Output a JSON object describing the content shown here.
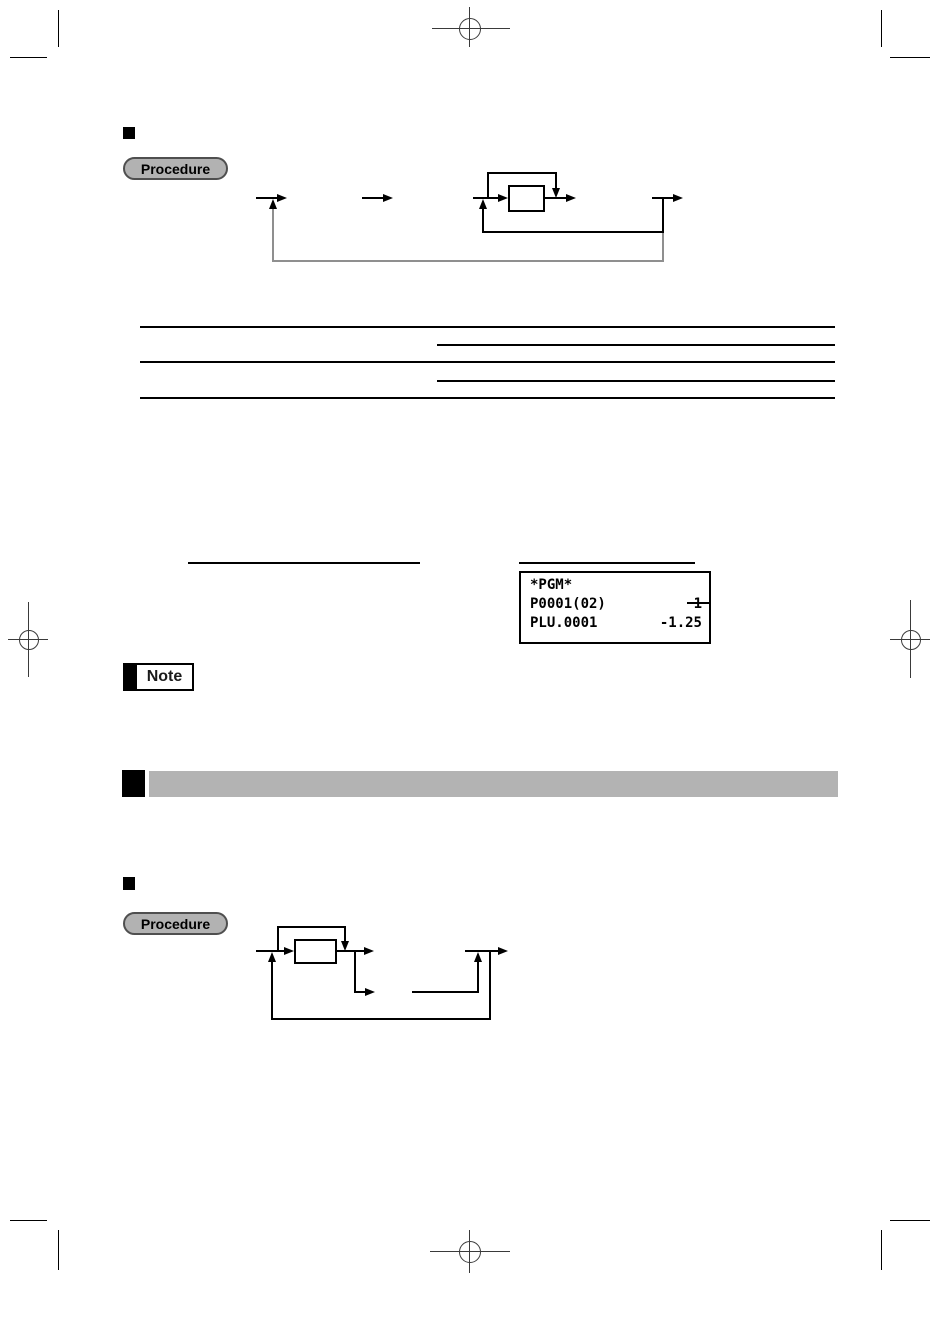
{
  "document": {
    "procedure_badge_1": "Procedure",
    "procedure_badge_2": "Procedure",
    "note_badge": "Note",
    "display_sample": {
      "line1": "*PGM*",
      "line2_left": "P0001(02)",
      "line2_right": "1",
      "line3_left": "PLU.0001",
      "line3_right": "-1.25"
    },
    "colors": {
      "section_bar_gray": "#b3b3b3",
      "badge_gray": "#b2b2b2",
      "loop_line_gray": "#8f8f8f"
    }
  }
}
